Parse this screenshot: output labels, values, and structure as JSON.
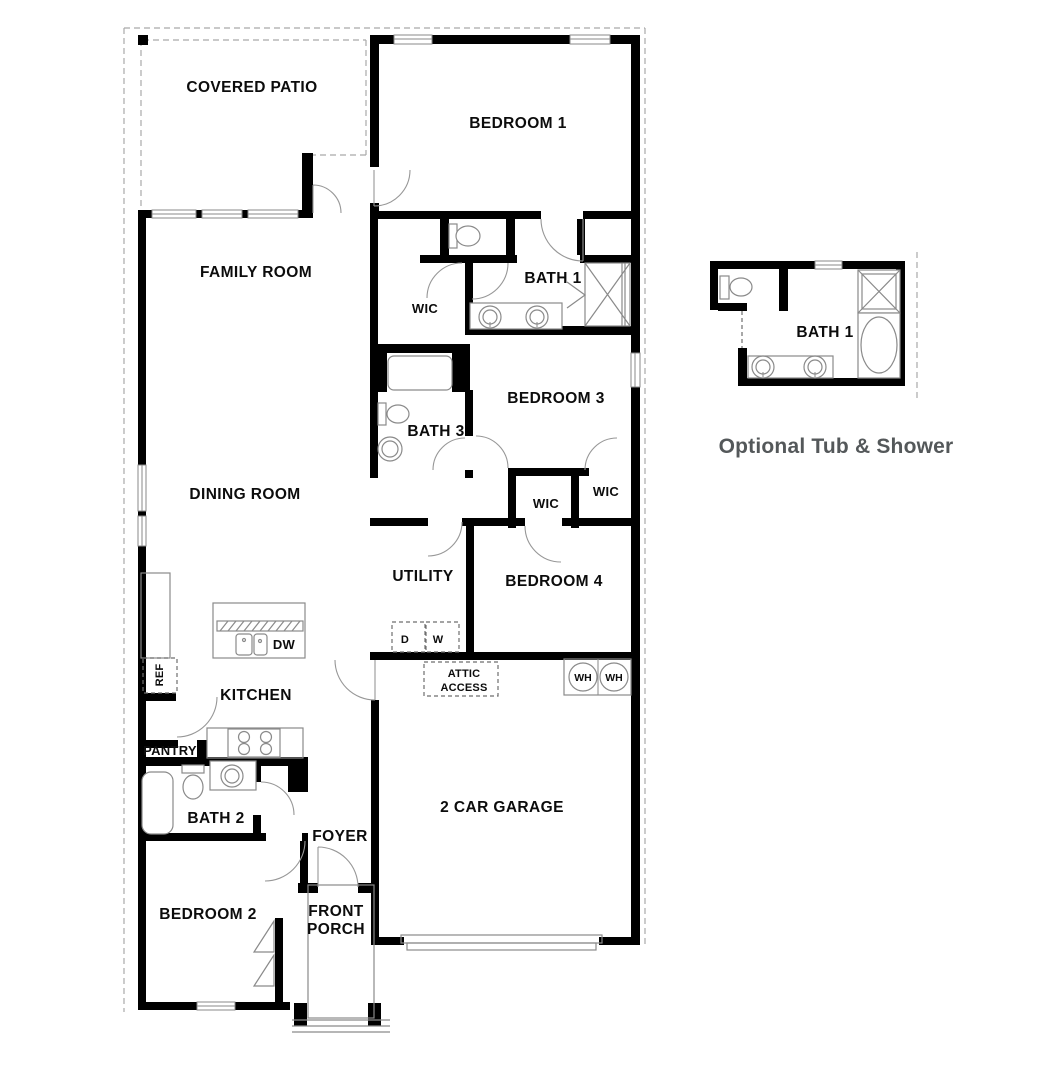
{
  "plan": {
    "rooms": {
      "covered_patio": "COVERED PATIO",
      "bedroom1": "BEDROOM 1",
      "family_room": "FAMILY ROOM",
      "wic_primary": "WIC",
      "bath1": "BATH 1",
      "bath3": "BATH 3",
      "bedroom3": "BEDROOM 3",
      "dining_room": "DINING ROOM",
      "wic_bedroom4": "WIC",
      "wic_bedroom3": "WIC",
      "utility": "UTILITY",
      "bedroom4": "BEDROOM 4",
      "kitchen": "KITCHEN",
      "pantry": "PANTRY",
      "bath2": "BATH 2",
      "garage": "2 CAR GARAGE",
      "foyer": "FOYER",
      "bedroom2": "BEDROOM 2",
      "front_porch_line1": "FRONT",
      "front_porch_line2": "PORCH"
    },
    "labels": {
      "dw": "DW",
      "ref": "REF",
      "dryer": "D",
      "washer": "W",
      "wh": "WH",
      "attic_line1": "ATTIC",
      "attic_line2": "ACCESS"
    }
  },
  "detail": {
    "room": "BATH 1",
    "caption": "Optional Tub & Shower"
  },
  "colors": {
    "wall": "#000000",
    "thin_line": "#8a8a8a",
    "dashed_line": "#a9a9a9",
    "label": "#0c0c0c",
    "caption": "#54585a",
    "background": "#ffffff"
  }
}
